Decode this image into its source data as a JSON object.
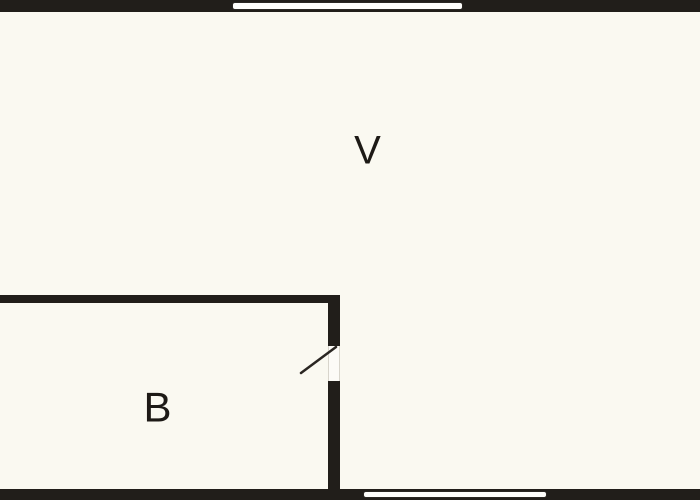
{
  "diagram": {
    "type": "floor-plan",
    "rooms": [
      {
        "id": "V",
        "label": "V"
      },
      {
        "id": "B",
        "label": "B"
      }
    ],
    "features": {
      "windows": [
        "top-wall-window",
        "bottom-wall-window"
      ],
      "doors": [
        "interior-door-between-V-and-B"
      ]
    }
  },
  "colors": {
    "background": "#FAF9F1",
    "wall": "#211E1A",
    "window_fill": "#FEFEFC",
    "window_border": "#2A2723",
    "door_line": "#2A2622",
    "label_text": "#1D1A16"
  }
}
